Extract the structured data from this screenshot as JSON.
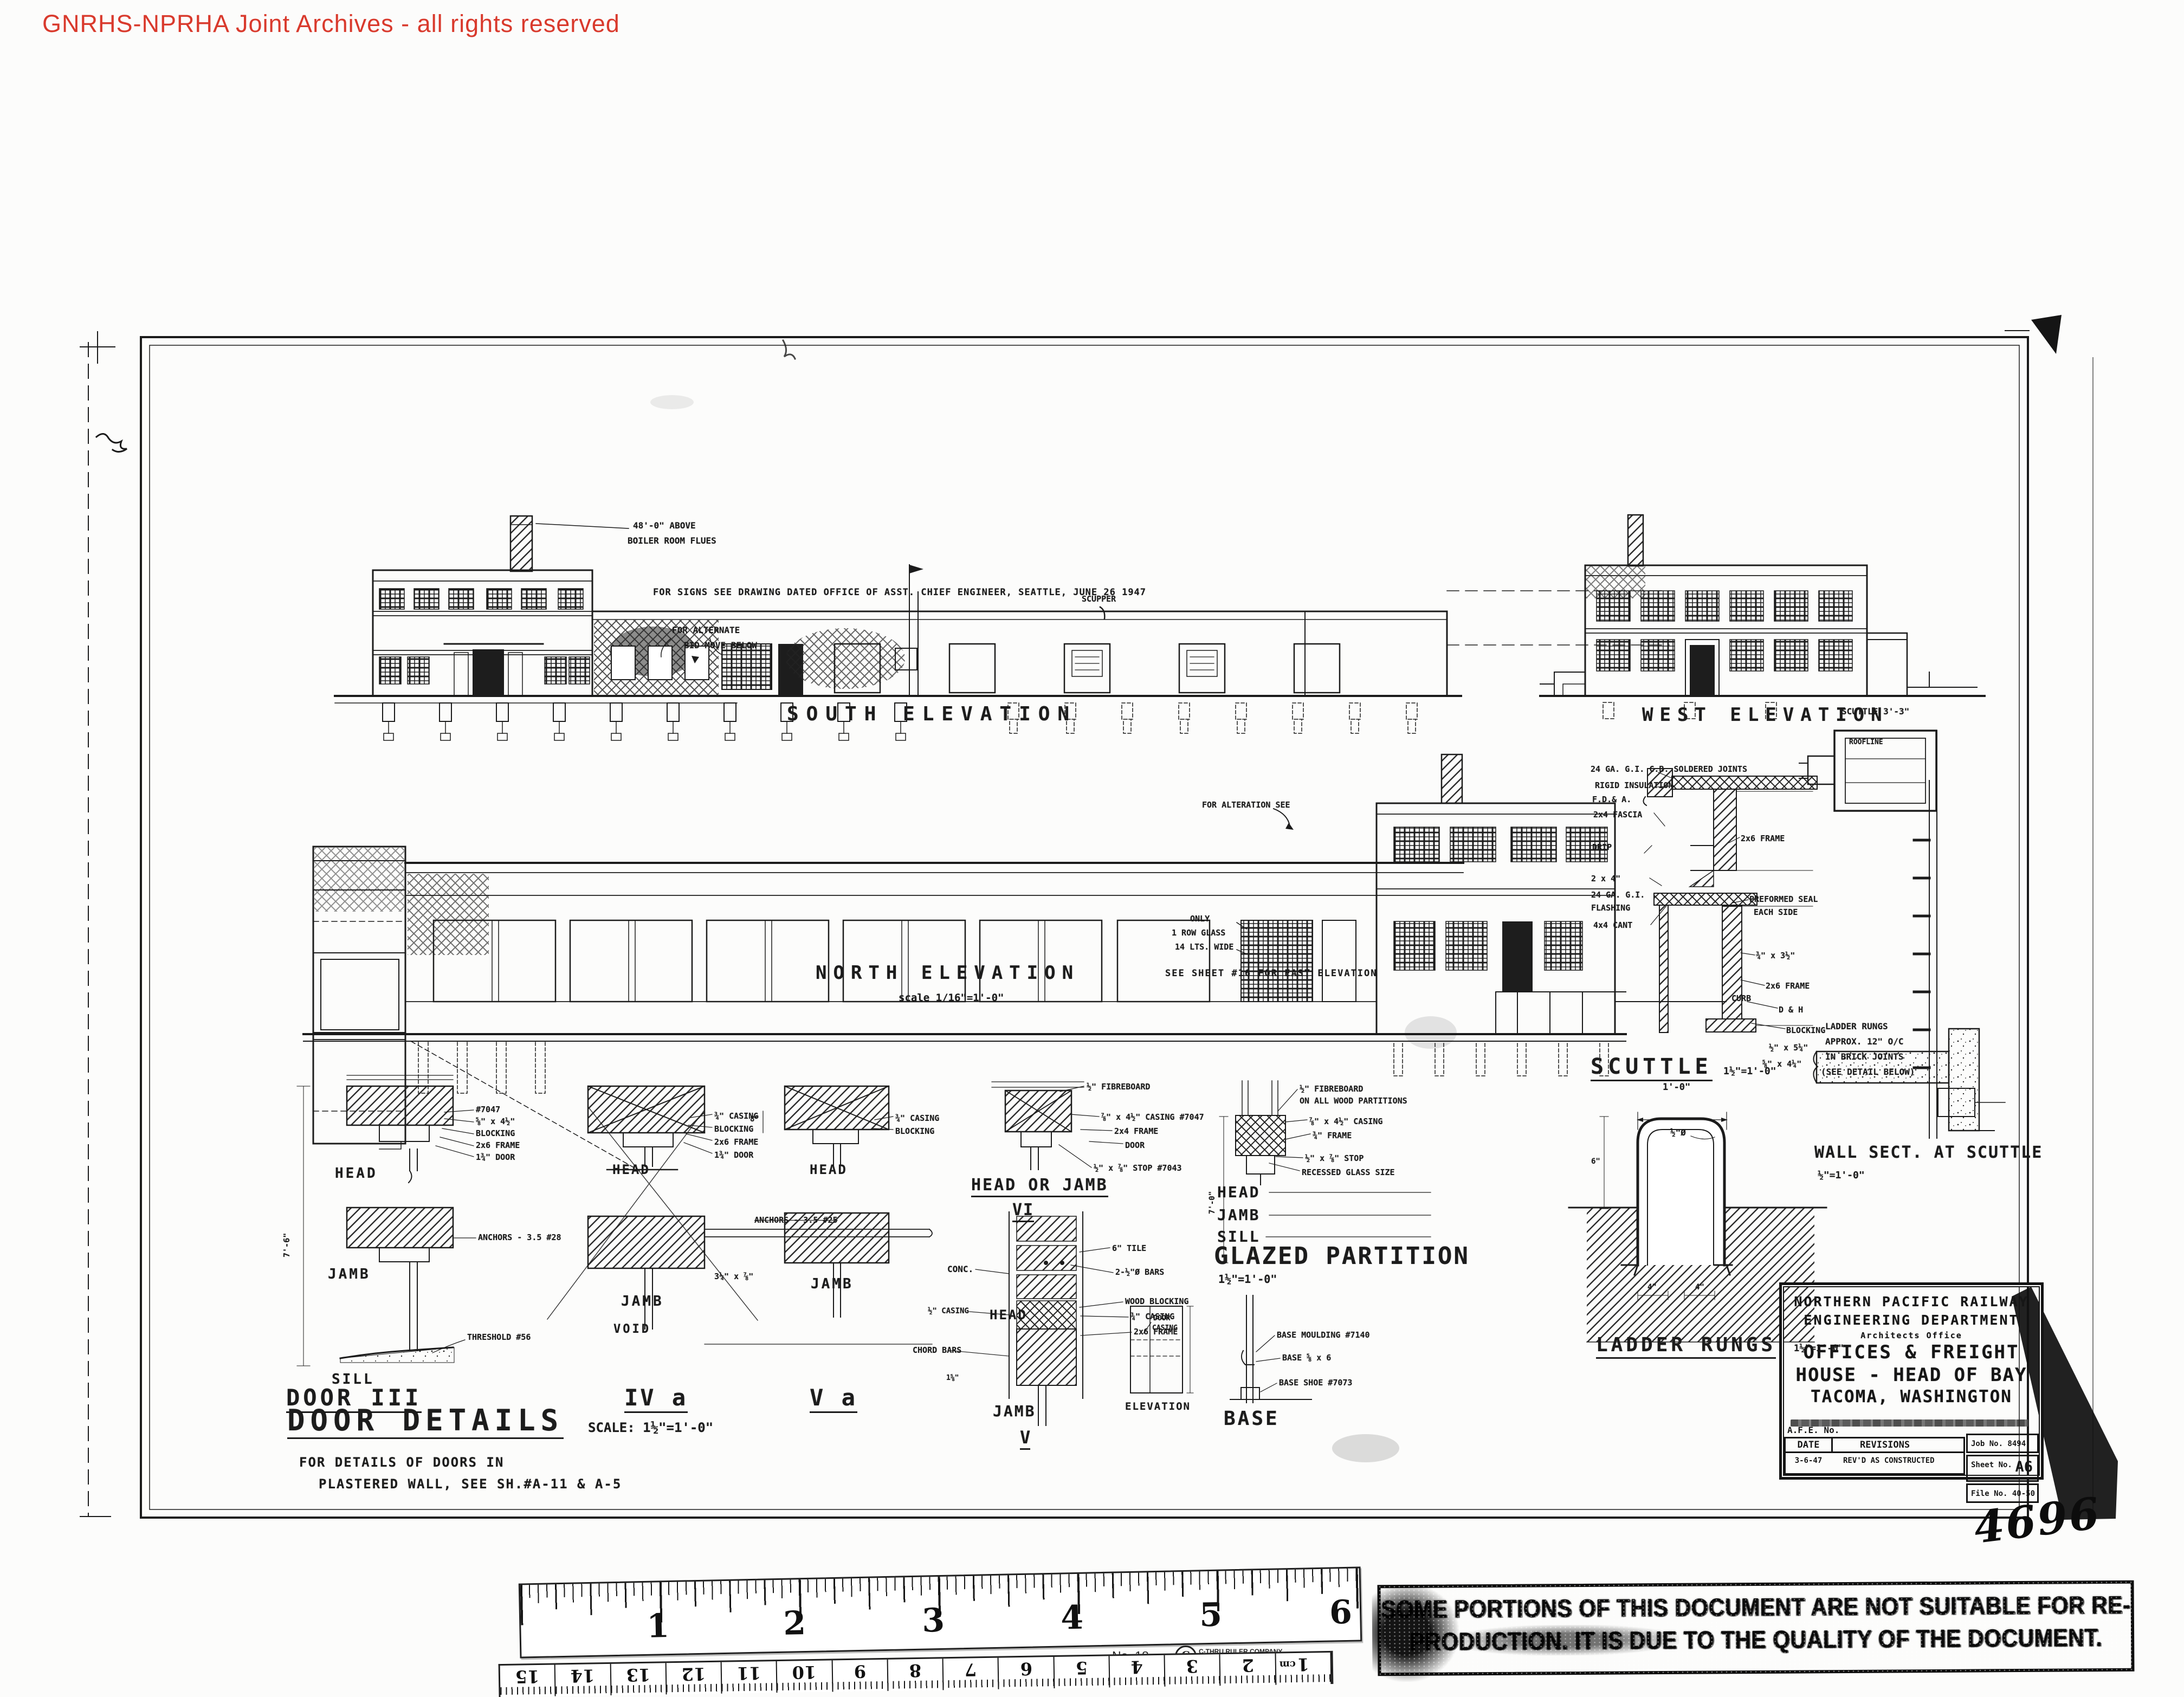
{
  "watermark": {
    "text": "GNRHS-NPRHA Joint Archives - all rights reserved"
  },
  "south": {
    "title": "SOUTH ELEVATION",
    "flue1": "48'-0\" ABOVE",
    "flue2": "BOILER ROOM FLUES",
    "alt1": "FOR ALTERNATE",
    "alt2": "BID MOVE BELOW",
    "signs": "FOR SIGNS SEE DRAWING DATED OFFICE OF ASST. CHIEF ENGINEER, SEATTLE, JUNE 26 1947",
    "scupper": "SCUPPER"
  },
  "west": {
    "title": "WEST ELEVATION"
  },
  "north": {
    "title": "NORTH ELEVATION",
    "scale": "scale 1/16\"=1'-0\"",
    "east_note": "SEE SHEET #16 FOR EAST ELEVATION",
    "alteration": "FOR ALTERATION SEE",
    "glass1": "ONLY",
    "glass2": "1 ROW GLASS",
    "glass3": "14 LTS. WIDE",
    "curb": "CURB"
  },
  "scuttle": {
    "plan_label": "SCUTTLE 3'-3\"",
    "roofline": "ROOFLINE",
    "ann_left": [
      "24 GA. G.I. C.B. SOLDERED JOINTS",
      "RIGID INSULATION",
      "F.D.& A.",
      "2x4 FASCIA",
      "DRIP",
      "2 x 4\"",
      "24 GA. G.I.",
      "FLASHING",
      "4x4 CANT"
    ],
    "ann_right": [
      "2x6 FRAME",
      "PREFORMED SEAL",
      "EACH SIDE",
      "¾\" x 3½\"",
      "2x6 FRAME",
      "D & H",
      "BLOCKING",
      "½\" x 5¼\"",
      "⅝\" x 4¼\""
    ],
    "title": "SCUTTLE",
    "scale": "1½\"=1'-0\"",
    "ladder_note": [
      "LADDER RUNGS",
      "APPROX. 12\" O/C",
      "IN BRICK JOINTS",
      "(SEE DETAIL BELOW)"
    ]
  },
  "wall_sect": {
    "title": "WALL SECT. AT SCUTTLE",
    "scale": "½\"=1'-0\""
  },
  "ladder": {
    "dim_w": "1'-0\"",
    "dim_dia": "½\"Ø",
    "dim_6": "6\"",
    "dim_4a": "4\"",
    "dim_4b": "4\"",
    "title": "LADDER RUNGS",
    "scale": "1½\"=1'-0\""
  },
  "doors": {
    "title": "DOOR DETAILS",
    "scale": "SCALE: 1½\"=1'-0\"",
    "note1": "FOR DETAILS OF DOORS IN",
    "note2": "PLASTERED WALL, SEE SH.#A-11 & A-5",
    "head": "HEAD",
    "jamb": "JAMB",
    "sill": "SILL",
    "d3": {
      "label": "DOOR III",
      "dim": "7'-6\"",
      "ann": [
        "#7047",
        "⅝\" x 4½\"",
        "BLOCKING",
        "2x6 FRAME",
        "1¾\" DOOR"
      ],
      "anchors": "ANCHORS - 3.5 #28",
      "threshold": "THRESHOLD #56"
    },
    "d4": {
      "label": "IV a",
      "void": "VOID",
      "dim": "3¼\" x ⅞\"",
      "ann": [
        "¾\" CASING",
        "BLOCKING",
        "2x6 FRAME",
        "1¾\" DOOR"
      ],
      "anchors": "ANCHORS - 3.5 #25"
    },
    "d5": {
      "label": "V a",
      "dim": "8\"",
      "ann": [
        "¾\" CASING",
        "BLOCKING"
      ]
    }
  },
  "d6": {
    "title": "HEAD OR JAMB",
    "numeral": "VI",
    "ann": [
      "½\" FIBREBOARD",
      "⅞\" x 4½\" CASING #7047",
      "2x4 FRAME",
      "DOOR",
      "½\" x ⅞\" STOP #7043"
    ]
  },
  "tile": {
    "head": "HEAD",
    "jamb": "JAMB",
    "numeral": "V",
    "conc": "CONC.",
    "casing_l": "½\" CASING",
    "chord": "CHORD BARS",
    "dim": "1⅝\"",
    "ann": [
      "6\" TILE",
      "2-½\"Ø BARS",
      "WOOD BLOCKING",
      "¾\" CASING",
      "2x6 FRAME"
    ]
  },
  "glazed": {
    "head": "HEAD",
    "jamb": "JAMB",
    "sill": "SILL",
    "title": "GLAZED PARTITION",
    "scale": "1½\"=1'-0\"",
    "dim": "7'-0\"",
    "ann": [
      "½\" FIBREBOARD",
      "ON ALL WOOD PARTITIONS",
      "⅞\" x 4½\" CASING",
      "¾\" FRAME",
      "½\" x ⅞\" STOP",
      "RECESSED GLASS SIZE"
    ]
  },
  "elev_detail": {
    "title": "ELEVATION",
    "ann1": "DOOR",
    "ann2": "CASING"
  },
  "base_detail": {
    "title": "BASE",
    "ann": [
      "BASE MOULDING #7140",
      "BASE ⅝ x 6",
      "BASE SHOE #7073"
    ]
  },
  "titleblock": {
    "l1": "NORTHERN PACIFIC RAILWAY",
    "l2": "ENGINEERING DEPARTMENT",
    "l3": "Architects Office",
    "l4": "OFFICES & FREIGHT",
    "l5": "HOUSE - HEAD OF BAY",
    "l6": "TACOMA, WASHINGTON",
    "afe": "A.F.E. No.",
    "date_h": "DATE",
    "rev_h": "REVISIONS",
    "rev_date": "3-6-47",
    "rev_text": "REV'D AS CONSTRUCTED",
    "job": "Job No. 8494",
    "sheet_label": "Sheet No.",
    "sheet_no": "A6",
    "file": "File No. 40-50",
    "hand": "4696"
  },
  "ruler": {
    "inches": [
      "1",
      "2",
      "3",
      "4",
      "5",
      "6"
    ],
    "model": "No. 18",
    "logo_letter": "C",
    "brand": "C-THRU RULER COMPANY",
    "brand2": "U.S.A.",
    "cm": [
      "15",
      "14",
      "13",
      "12",
      "11",
      "10",
      "9",
      "8",
      "7",
      "6",
      "5",
      "4",
      "3",
      "2",
      "1"
    ],
    "cm_unit": "cm"
  },
  "stamp": {
    "line1": "SOME PORTIONS OF THIS DOCUMENT ARE NOT SUITABLE FOR RE-",
    "line2": "PRODUCTION. IT IS DUE TO THE QUALITY OF THE DOCUMENT."
  }
}
